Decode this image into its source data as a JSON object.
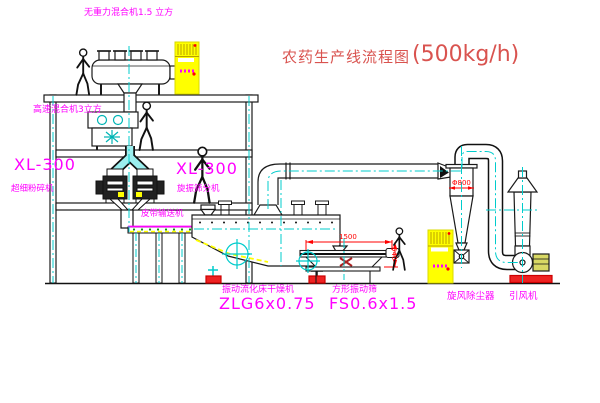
{
  "title": {
    "text_cn": "农药生产线流程图",
    "capacity": "(500kg/h)"
  },
  "labels": {
    "gravity_mixer": "无重力混合机1.5 立方",
    "high_speed_mixer": "高速混合机3立方",
    "mill_left_model": "XL-300",
    "mill_left_name": "超细粉碎机",
    "mill_right_model": "XL-300",
    "mill_right_name": "旋振筛分机",
    "belt_conveyor": "皮带输送机",
    "dryer_name": "振动流化床干燥机",
    "dryer_model": "ZLG6x0.75",
    "sieve_name": "方形振动筛",
    "sieve_model": "FS0.6x1.5",
    "cyclone_name": "旋风除尘器",
    "fan_name": "引风机"
  },
  "dimensions": {
    "cyclone_diameter": "Φ800",
    "sieve_length": "1500",
    "sieve_height": "540"
  },
  "colors": {
    "label_magenta": "#ff00ff",
    "title_red": "#d9534f",
    "dimension_red": "#ff0000",
    "centerline_cyan": "#00cccc",
    "cabinet_yellow": "#ffff00",
    "line_black": "#1a1a1a",
    "base_red": "#ee2222",
    "dot_green": "#009900"
  }
}
